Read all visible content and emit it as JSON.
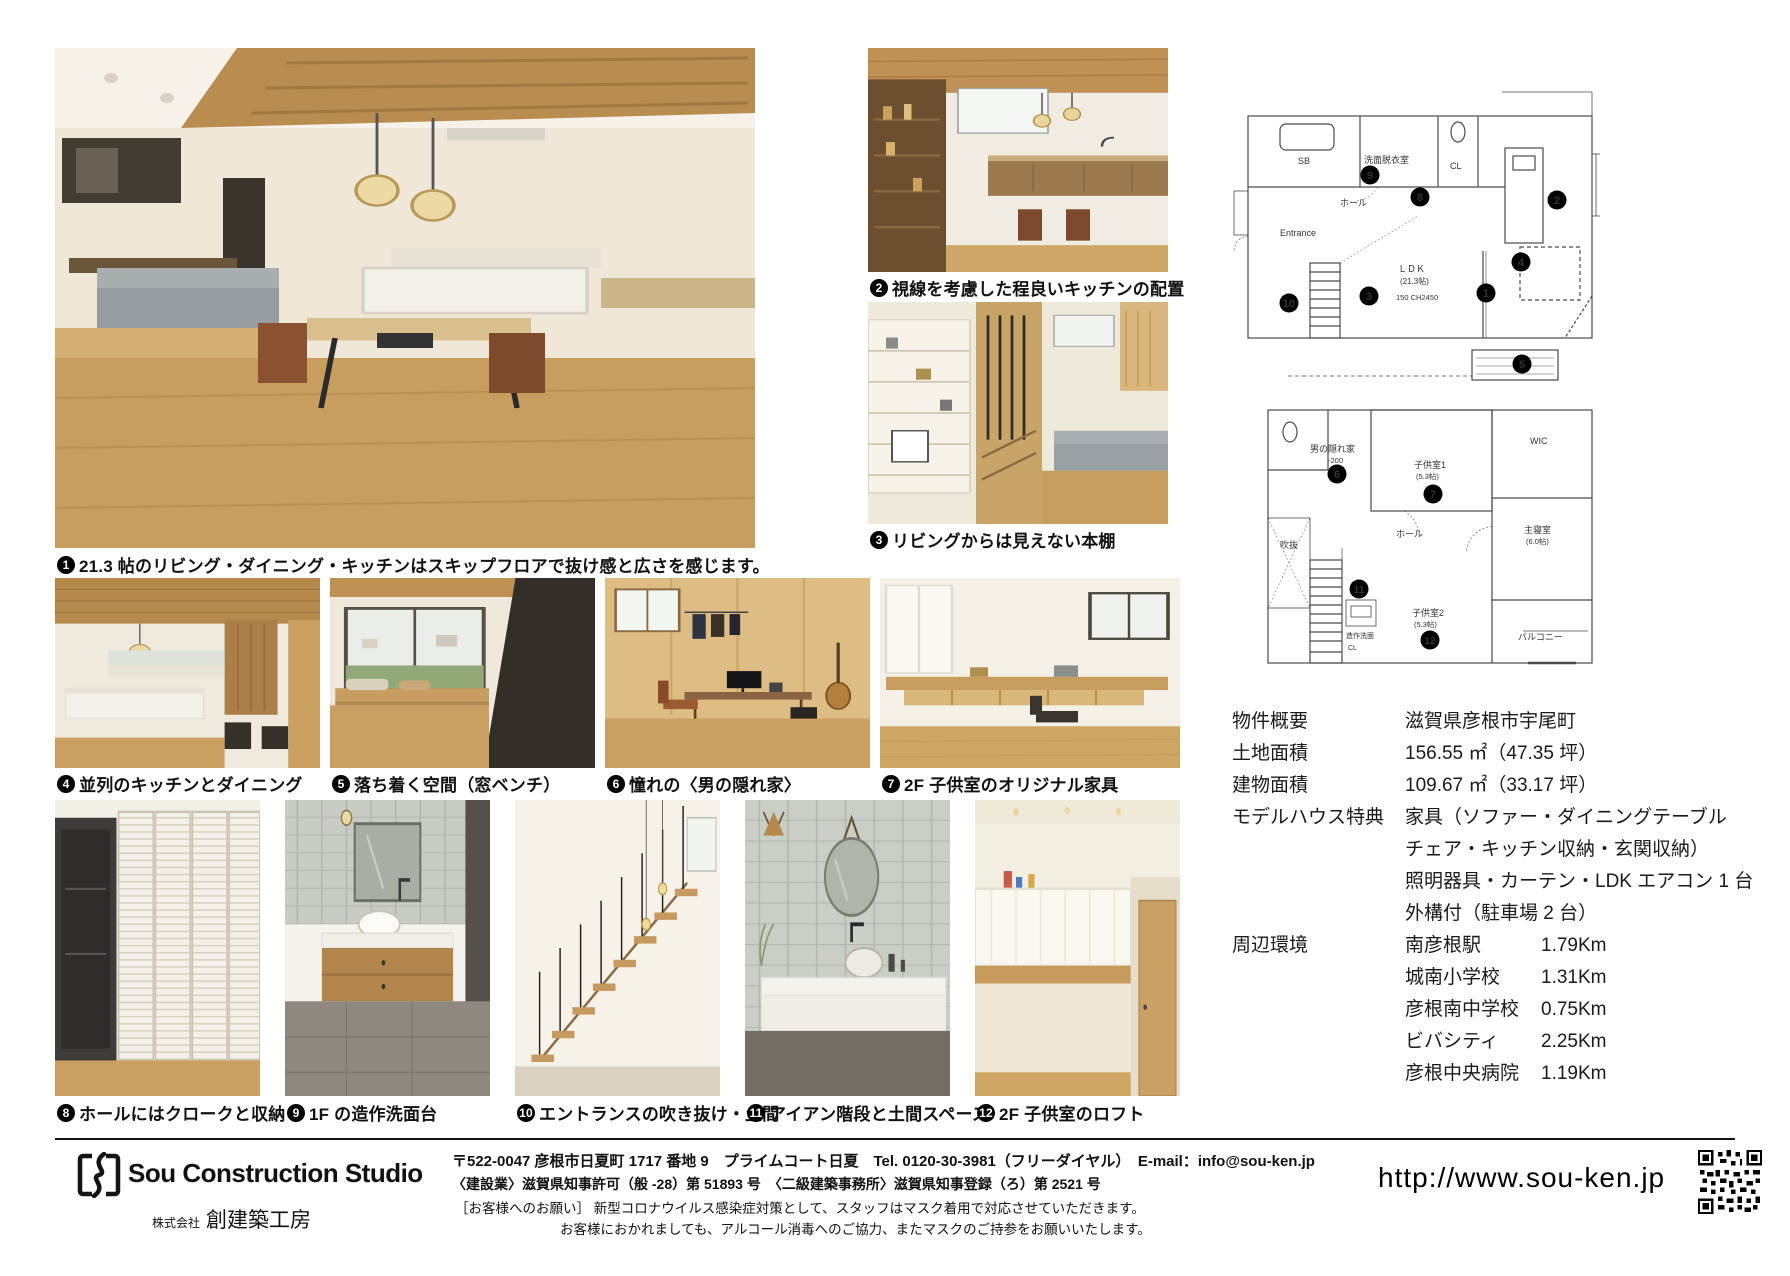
{
  "captions": {
    "c1": {
      "num": "1",
      "text": "21.3 帖のリビング・ダイニング・キッチンはスキップフロアで抜け感と広さを感じます。"
    },
    "c2": {
      "num": "2",
      "text": "視線を考慮した程良いキッチンの配置"
    },
    "c3": {
      "num": "3",
      "text": "リビングからは見えない本棚"
    },
    "c4": {
      "num": "4",
      "text": "並列のキッチンとダイニング"
    },
    "c5": {
      "num": "5",
      "text": "落ち着く空間（窓ベンチ）"
    },
    "c6": {
      "num": "6",
      "text": "憧れの〈男の隠れ家〉"
    },
    "c7": {
      "num": "7",
      "text": "2F 子供室のオリジナル家具"
    },
    "c8": {
      "num": "8",
      "text": "ホールにはクロークと収納"
    },
    "c9": {
      "num": "9",
      "text": "1F の造作洗面台"
    },
    "c10": {
      "num": "10",
      "text": "エントランスの吹き抜け・土間"
    },
    "c11": {
      "num": "11",
      "text": "アイアン階段と土間スペース"
    },
    "c12": {
      "num": "12",
      "text": "2F 子供室のロフト"
    }
  },
  "plans": {
    "f1": {
      "labels": {
        "sb": "SB",
        "wash": "洗面脱衣室",
        "cl": "CL",
        "hall": "ホール",
        "entrance": "Entrance",
        "ldk": "ＬＤＫ",
        "ldk_size": "(21.3帖)",
        "ldk_note": "150 CH2450"
      },
      "markers": [
        "1",
        "2",
        "3",
        "4",
        "8",
        "9",
        "10"
      ]
    },
    "f2": {
      "labels": {
        "hideout": "男の隠れ家",
        "hideout_lv": "-200",
        "kids1": "子供室1",
        "kids1_size": "(5.3帖)",
        "wic": "WIC",
        "hall": "ホール",
        "master": "主寝室",
        "master_size": "(6.0帖)",
        "void": "吹抜",
        "wash": "造作洗面",
        "cl": "CL",
        "kids2": "子供室2",
        "kids2_size": "(5.3帖)",
        "balcony": "バルコニー"
      },
      "markers": [
        "5",
        "6",
        "7",
        "11",
        "12"
      ]
    }
  },
  "property": {
    "label_overview": "物件概要",
    "value_overview": "滋賀県彦根市宇尾町",
    "label_land": "土地面積",
    "value_land": "156.55 ㎡（47.35 坪）",
    "label_building": "建物面積",
    "value_building": "109.67 ㎡（33.17 坪）",
    "label_model": "モデルハウス特典",
    "model_lines": [
      "家具（ソファー・ダイニングテーブル",
      "チェア・キッチン収納・玄関収納）",
      "照明器具・カーテン・LDK エアコン 1 台",
      "外構付（駐車場 2 台）"
    ],
    "label_env": "周辺環境",
    "env": [
      {
        "place": "南彦根駅",
        "dist": "1.79Km"
      },
      {
        "place": "城南小学校",
        "dist": "1.31Km"
      },
      {
        "place": "彦根南中学校",
        "dist": "0.75Km"
      },
      {
        "place": "ビバシティ",
        "dist": "2.25Km"
      },
      {
        "place": "彦根中央病院",
        "dist": "1.19Km"
      }
    ]
  },
  "footer": {
    "logo_text": "Sou Construction Studio",
    "company_prefix": "株式会社",
    "company_name": "創建築工房",
    "address_line": "〒522-0047 彦根市日夏町 1717 番地 9　プライムコート日夏　Tel. 0120-30-3981（フリーダイヤル）　E-mail：info@sou-ken.jp",
    "license_line": "〈建設業〉滋賀県知事許可（般 -28）第 51893 号　〈二級建築事務所〉滋賀県知事登録（ろ）第 2521 号",
    "notice_label": "［お客様へのお願い］",
    "notice1": "新型コロナウイルス感染症対策として、スタッフはマスク着用で対応させていただきます。",
    "notice2": "お客様におかれましても、アルコール消毒へのご協力、またマスクのご持参をお願いいたします。",
    "url": "http://www.sou-ken.jp"
  },
  "colors": {
    "ink": "#111111",
    "wood": "#c49a5e",
    "marker": "#000000"
  }
}
